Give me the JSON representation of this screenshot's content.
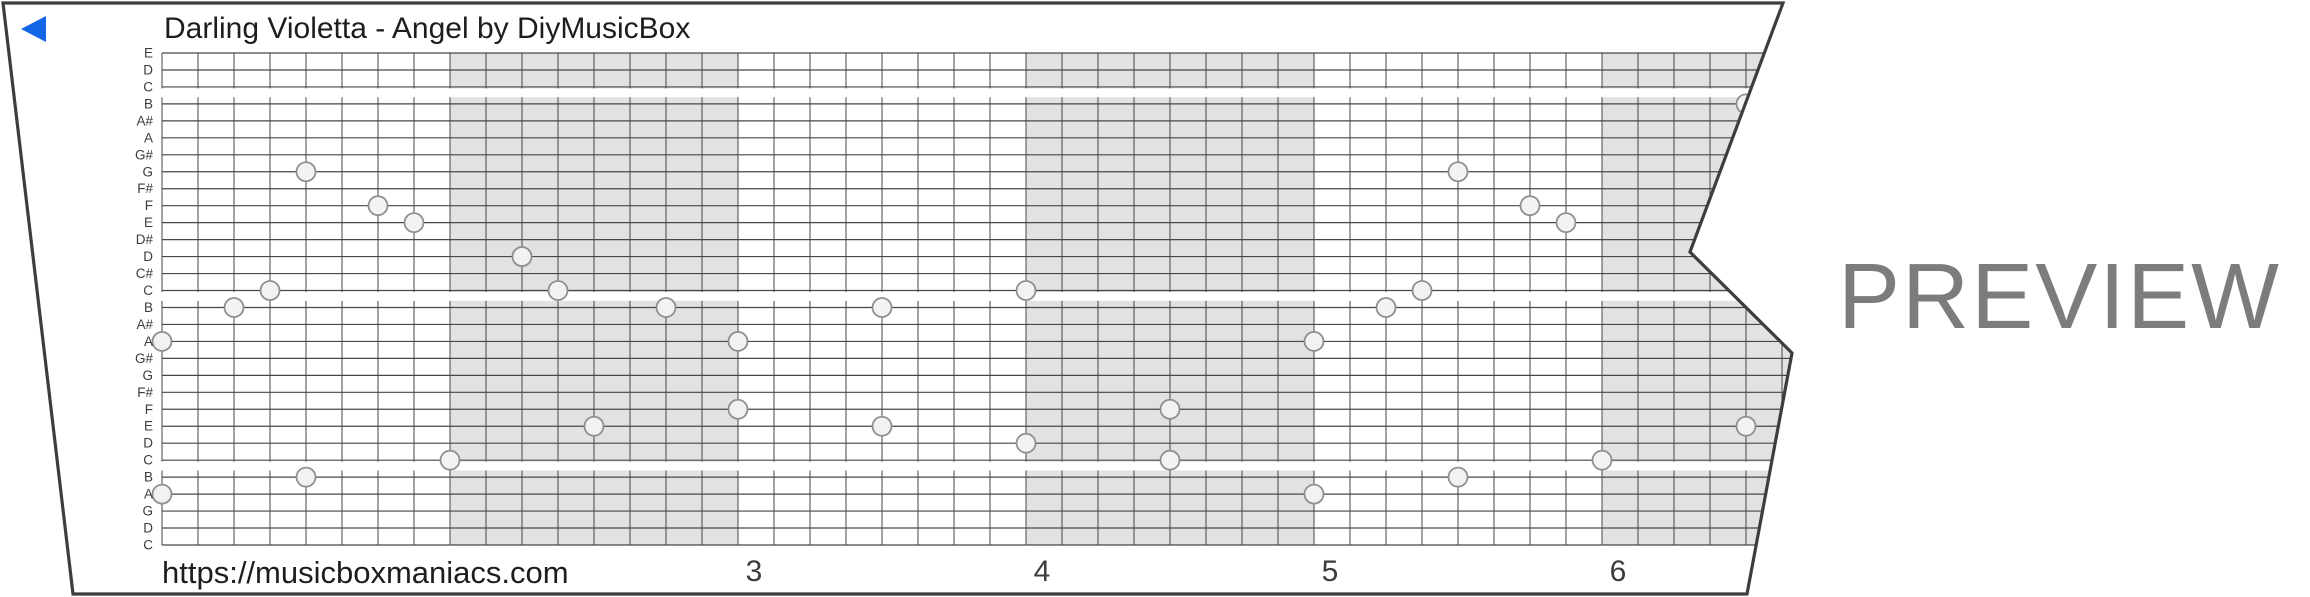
{
  "title": "Darling Violetta - Angel by DiyMusicBox",
  "watermark": "PREVIEW",
  "footer": {
    "url": "https://musicboxmaniacs.com"
  },
  "player": {
    "icon": "play-left-triangle",
    "color": "#1565e8"
  },
  "colors": {
    "paper": "#ffffff",
    "strip_border": "#3d3d3d",
    "grid_line": "#474747",
    "measure_shading": "#e2e2e2",
    "note_fill": "#f2f2f2",
    "note_stroke": "#8f8f8f",
    "text_dark": "#1d1d1d",
    "label_gray": "#3c3c3c",
    "watermark_gray": "#7c7c7c"
  },
  "strip": {
    "note_labels": [
      "E",
      "D",
      "C",
      "B",
      "A#",
      "A",
      "G#",
      "G",
      "F#",
      "F",
      "E",
      "D#",
      "D",
      "C#",
      "C",
      "B",
      "A#",
      "A",
      "G#",
      "G",
      "F#",
      "F",
      "E",
      "D",
      "C",
      "B",
      "A",
      "G",
      "D",
      "C"
    ],
    "section_break_after_lines": [
      2,
      14,
      24
    ],
    "columns_per_measure": 8,
    "shaded_measure_start_cols": [
      8,
      24,
      40
    ],
    "measure_numbers": [
      {
        "label": "3",
        "col": 16
      },
      {
        "label": "4",
        "col": 24
      },
      {
        "label": "5",
        "col": 32
      },
      {
        "label": "6",
        "col": 40
      }
    ],
    "notes": [
      {
        "col": 0,
        "line": 17,
        "pitch": "A"
      },
      {
        "col": 0,
        "line": 26,
        "pitch": "A"
      },
      {
        "col": 2,
        "line": 15,
        "pitch": "B"
      },
      {
        "col": 3,
        "line": 14,
        "pitch": "C"
      },
      {
        "col": 4,
        "line": 7,
        "pitch": "G"
      },
      {
        "col": 4,
        "line": 25,
        "pitch": "B"
      },
      {
        "col": 6,
        "line": 9,
        "pitch": "F"
      },
      {
        "col": 7,
        "line": 10,
        "pitch": "E"
      },
      {
        "col": 8,
        "line": 24,
        "pitch": "C"
      },
      {
        "col": 10,
        "line": 12,
        "pitch": "D"
      },
      {
        "col": 11,
        "line": 14,
        "pitch": "C"
      },
      {
        "col": 12,
        "line": 22,
        "pitch": "E"
      },
      {
        "col": 14,
        "line": 15,
        "pitch": "B"
      },
      {
        "col": 16,
        "line": 17,
        "pitch": "A"
      },
      {
        "col": 16,
        "line": 21,
        "pitch": "F"
      },
      {
        "col": 20,
        "line": 15,
        "pitch": "B"
      },
      {
        "col": 20,
        "line": 22,
        "pitch": "E"
      },
      {
        "col": 24,
        "line": 14,
        "pitch": "C"
      },
      {
        "col": 24,
        "line": 23,
        "pitch": "D"
      },
      {
        "col": 28,
        "line": 21,
        "pitch": "F"
      },
      {
        "col": 28,
        "line": 24,
        "pitch": "C"
      },
      {
        "col": 32,
        "line": 17,
        "pitch": "A"
      },
      {
        "col": 32,
        "line": 26,
        "pitch": "A"
      },
      {
        "col": 34,
        "line": 15,
        "pitch": "B"
      },
      {
        "col": 35,
        "line": 14,
        "pitch": "C"
      },
      {
        "col": 36,
        "line": 7,
        "pitch": "G"
      },
      {
        "col": 36,
        "line": 25,
        "pitch": "B"
      },
      {
        "col": 38,
        "line": 9,
        "pitch": "F"
      },
      {
        "col": 39,
        "line": 10,
        "pitch": "E"
      },
      {
        "col": 40,
        "line": 24,
        "pitch": "C"
      },
      {
        "col": 44,
        "line": 3,
        "pitch": "B"
      },
      {
        "col": 44,
        "line": 22,
        "pitch": "E"
      }
    ]
  }
}
